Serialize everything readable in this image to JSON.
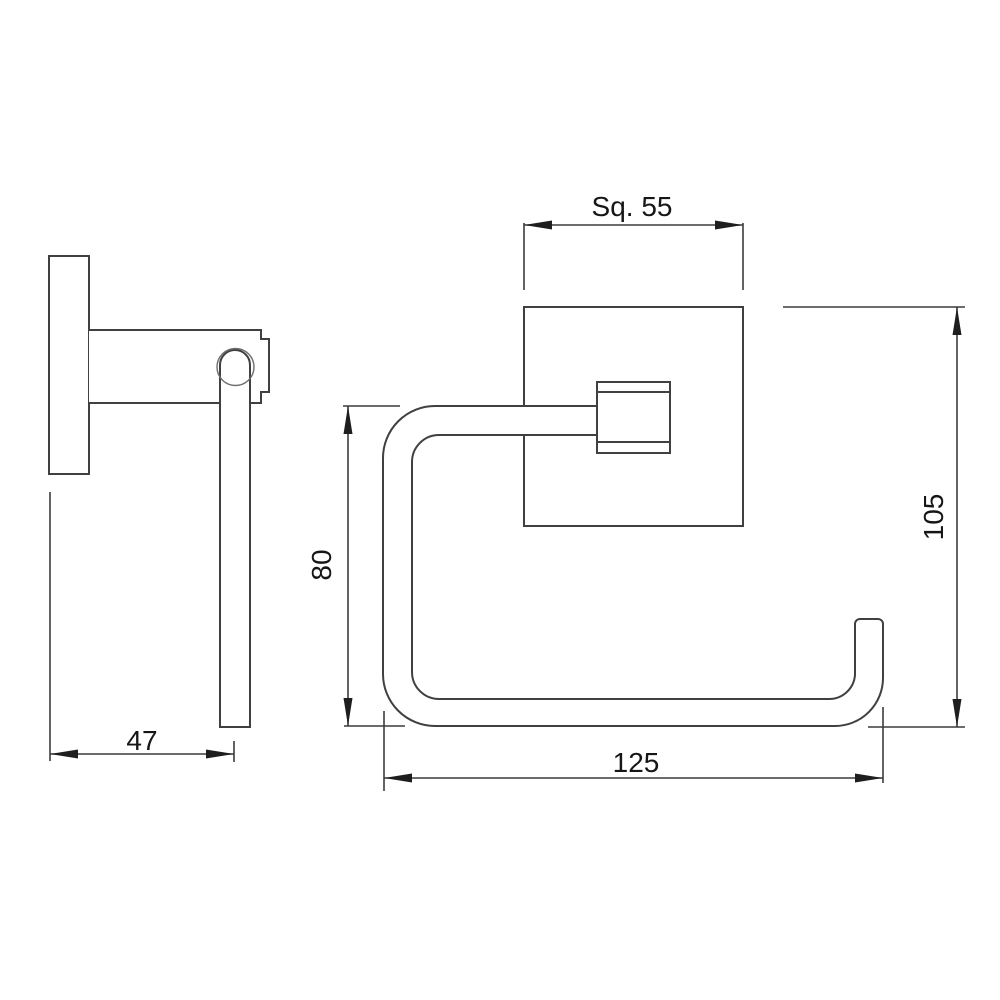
{
  "drawing": {
    "kind": "technical dimension drawing",
    "background_color": "#ffffff",
    "line_color": "#404040",
    "text_color": "#161616",
    "views": [
      {
        "id": "side-view",
        "description": "side profile of wall-mounted holder"
      },
      {
        "id": "front-view",
        "description": "front elevation of square-flange paper holder"
      }
    ]
  },
  "dims": {
    "square": "Sq. 55",
    "depth": "47",
    "inner_height": "80",
    "total_height": "105",
    "width": "125"
  }
}
